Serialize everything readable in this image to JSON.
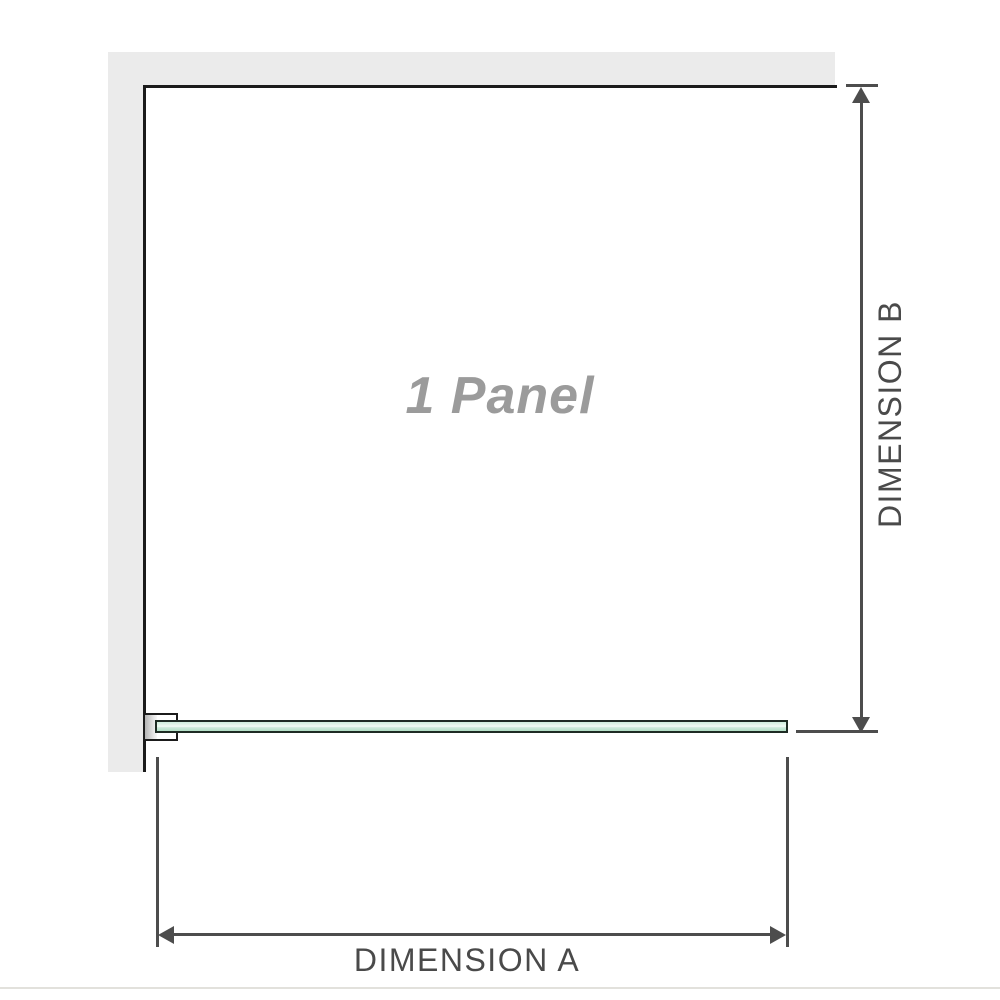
{
  "diagram": {
    "title": "shower screen plan view",
    "panel_label": "1 Panel",
    "dimension_a_label": "DIMENSION A",
    "dimension_b_label": "DIMENSION B",
    "colors": {
      "wall_fill": "#ebebeb",
      "outline": "#1b1b1b",
      "dimension_lines": "#4d4d4d",
      "dimension_text": "#4a4a4a",
      "panel_label_text": "#9b9b9b",
      "glass_fill_light": "#e3f4ea",
      "glass_fill_dark": "#b2dfc6",
      "glass_border": "#1e2b24",
      "floor_line": "#e2e1dc"
    }
  }
}
